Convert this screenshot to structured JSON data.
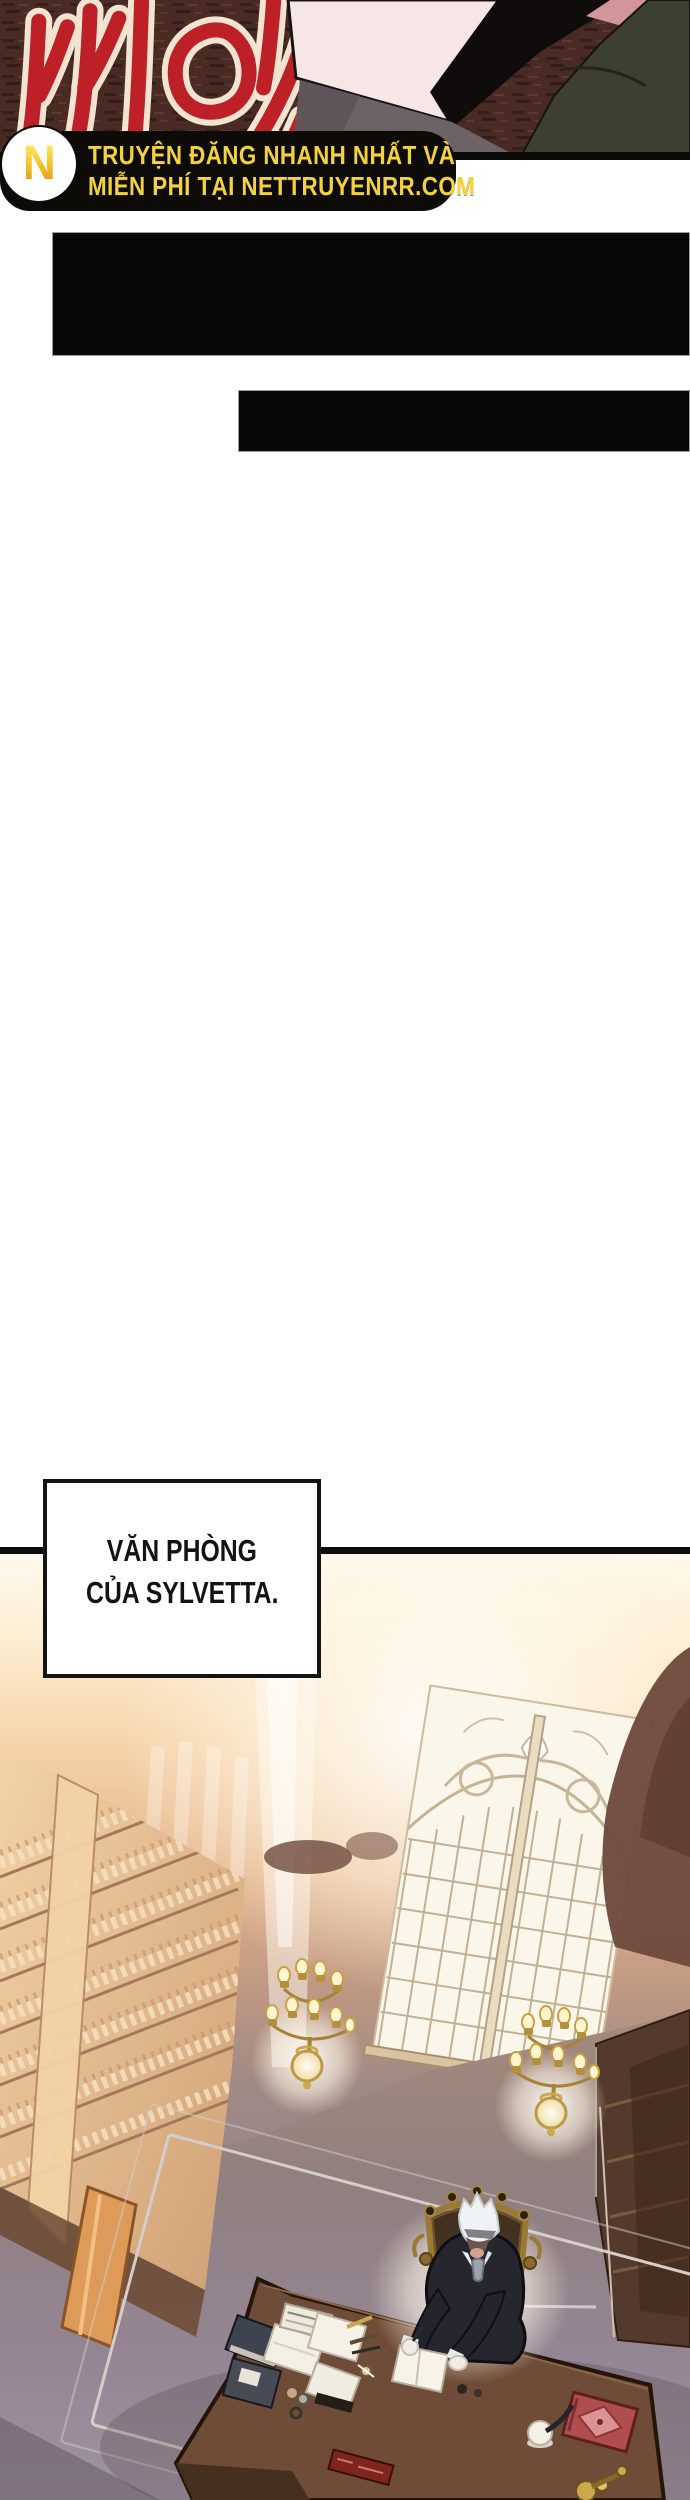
{
  "top_panel": {
    "sfx_text": "씨익",
    "sfx_color": "#bd2127",
    "bg_color": "#4a2b24"
  },
  "watermark": {
    "logo_letter": "N",
    "line1": "TRUYỆN ĐĂNG NHANH NHẤT VÀ",
    "line2": "MIỄN PHÍ TẠI NETTRUYENRR.COM",
    "text_color": "#f2d23d",
    "bg_color": "#0c0b07"
  },
  "blackout_panels": [
    {
      "label": "blacked-out-panel-1"
    },
    {
      "label": "blacked-out-panel-2"
    }
  ],
  "caption": {
    "line1": "VĂN PHÒNG",
    "line2": "CỦA SYLVETTA."
  },
  "scene_colors": {
    "wall_light": "#fff9ee",
    "wall_peach": "#e6b68c",
    "floor_mauve": "#968692",
    "desk_brown": "#6f4c37",
    "gold": "#c9a84c",
    "red_book": "#b04e4f"
  }
}
